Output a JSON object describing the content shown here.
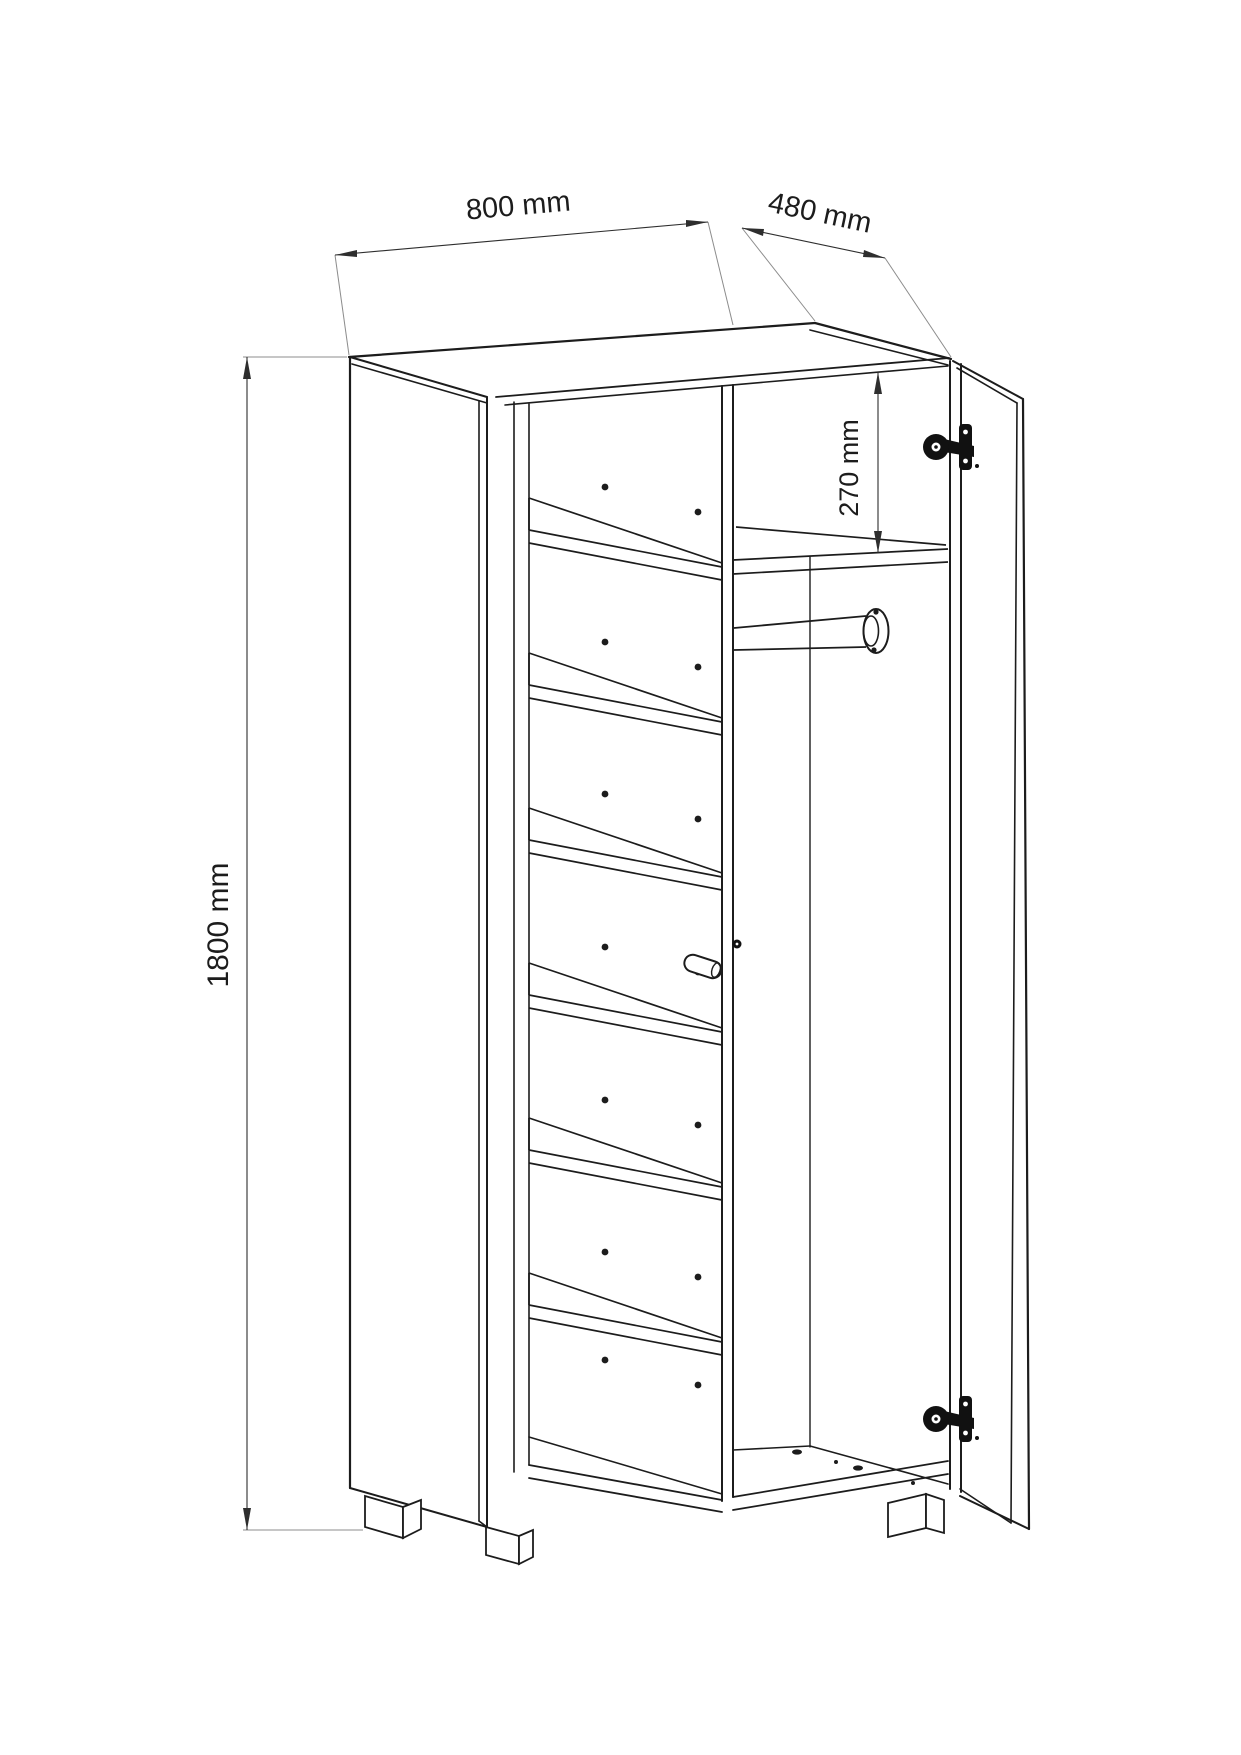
{
  "drawing": {
    "type": "furniture-technical-drawing",
    "subject": "two-door wardrobe, doors open, shelves left, hanging rail right",
    "dimensions": {
      "width": "800 mm",
      "depth": "480 mm",
      "height": "1800 mm",
      "top_compartment_height": "270 mm"
    },
    "features": {
      "left_shelf_count": 6,
      "hinge_count": 2,
      "feet_visible": 3,
      "clothes_rail": true,
      "shelf_pin_holes": true
    },
    "colors": {
      "line": "#1c1c1c",
      "dimension_line": "#2e2e2e",
      "extension_line": "#8c8c8c",
      "hardware": "#111111",
      "background": "#ffffff"
    }
  }
}
